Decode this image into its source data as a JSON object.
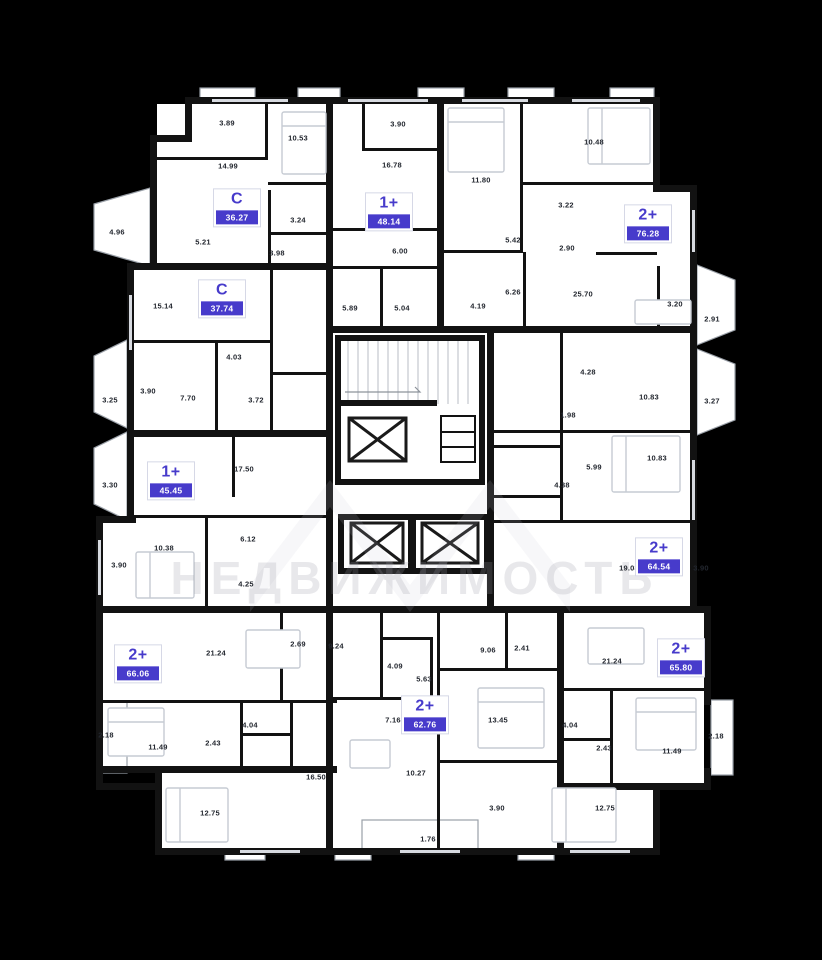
{
  "colors": {
    "background": "#000000",
    "floor": "#ffffff",
    "wall": "#121212",
    "accent": "#473bcb",
    "furniture": "#c6cbd3",
    "watermark": "#9b9ba6"
  },
  "watermark": {
    "text": "НЕДВИЖИМОСТЬ"
  },
  "apartments": [
    {
      "type": "С",
      "area": "36.27",
      "x": 237,
      "y": 208
    },
    {
      "type": "1+",
      "area": "48.14",
      "x": 389,
      "y": 212
    },
    {
      "type": "2+",
      "area": "76.28",
      "x": 648,
      "y": 224
    },
    {
      "type": "С",
      "area": "37.74",
      "x": 222,
      "y": 299
    },
    {
      "type": "1+",
      "area": "45.45",
      "x": 171,
      "y": 481
    },
    {
      "type": "2+",
      "area": "64.54",
      "x": 659,
      "y": 557
    },
    {
      "type": "2+",
      "area": "66.06",
      "x": 138,
      "y": 664
    },
    {
      "type": "2+",
      "area": "62.76",
      "x": 425,
      "y": 715
    },
    {
      "type": "2+",
      "area": "65.80",
      "x": 681,
      "y": 658
    }
  ],
  "rooms": [
    {
      "value": "3.89",
      "x": 227,
      "y": 123
    },
    {
      "value": "10.53",
      "x": 298,
      "y": 138
    },
    {
      "value": "14.99",
      "x": 228,
      "y": 166
    },
    {
      "value": "5.21",
      "x": 203,
      "y": 242
    },
    {
      "value": "3.24",
      "x": 298,
      "y": 220
    },
    {
      "value": "3.98",
      "x": 277,
      "y": 253
    },
    {
      "value": "4.96",
      "x": 117,
      "y": 232
    },
    {
      "value": "3.90",
      "x": 398,
      "y": 124
    },
    {
      "value": "16.78",
      "x": 392,
      "y": 165
    },
    {
      "value": "6.00",
      "x": 400,
      "y": 251
    },
    {
      "value": "5.89",
      "x": 350,
      "y": 308
    },
    {
      "value": "5.04",
      "x": 402,
      "y": 308
    },
    {
      "value": "11.80",
      "x": 481,
      "y": 180
    },
    {
      "value": "10.48",
      "x": 594,
      "y": 142
    },
    {
      "value": "3.22",
      "x": 566,
      "y": 205
    },
    {
      "value": "5.42",
      "x": 513,
      "y": 240
    },
    {
      "value": "2.90",
      "x": 567,
      "y": 248
    },
    {
      "value": "6.26",
      "x": 513,
      "y": 292
    },
    {
      "value": "4.19",
      "x": 478,
      "y": 306
    },
    {
      "value": "25.70",
      "x": 583,
      "y": 294
    },
    {
      "value": "3.20",
      "x": 675,
      "y": 304
    },
    {
      "value": "2.91",
      "x": 712,
      "y": 319
    },
    {
      "value": "15.14",
      "x": 163,
      "y": 306
    },
    {
      "value": "4.03",
      "x": 234,
      "y": 357
    },
    {
      "value": "3.90",
      "x": 148,
      "y": 391
    },
    {
      "value": "7.70",
      "x": 188,
      "y": 398
    },
    {
      "value": "3.72",
      "x": 256,
      "y": 400
    },
    {
      "value": "3.25",
      "x": 110,
      "y": 400
    },
    {
      "value": "17.50",
      "x": 244,
      "y": 469
    },
    {
      "value": "3.30",
      "x": 110,
      "y": 485
    },
    {
      "value": "10.38",
      "x": 164,
      "y": 548
    },
    {
      "value": "6.12",
      "x": 248,
      "y": 539
    },
    {
      "value": "3.90",
      "x": 119,
      "y": 565
    },
    {
      "value": "4.28",
      "x": 588,
      "y": 372
    },
    {
      "value": "10.83",
      "x": 649,
      "y": 397
    },
    {
      "value": "3.27",
      "x": 712,
      "y": 401
    },
    {
      "value": "1.98",
      "x": 568,
      "y": 415
    },
    {
      "value": "10.83",
      "x": 657,
      "y": 458
    },
    {
      "value": "5.99",
      "x": 594,
      "y": 467
    },
    {
      "value": "4.38",
      "x": 562,
      "y": 485
    },
    {
      "value": "19.08",
      "x": 629,
      "y": 568
    },
    {
      "value": "3.90",
      "x": 701,
      "y": 568
    },
    {
      "value": "4.25",
      "x": 246,
      "y": 584
    },
    {
      "value": "21.24",
      "x": 216,
      "y": 653
    },
    {
      "value": "2.69",
      "x": 298,
      "y": 644
    },
    {
      "value": "2.18",
      "x": 106,
      "y": 735
    },
    {
      "value": "11.49",
      "x": 158,
      "y": 747
    },
    {
      "value": "2.43",
      "x": 213,
      "y": 743
    },
    {
      "value": "4.04",
      "x": 250,
      "y": 725
    },
    {
      "value": "12.75",
      "x": 210,
      "y": 813
    },
    {
      "value": "16.50",
      "x": 316,
      "y": 777
    },
    {
      "value": "9.24",
      "x": 336,
      "y": 646
    },
    {
      "value": "4.09",
      "x": 395,
      "y": 666
    },
    {
      "value": "5.63",
      "x": 424,
      "y": 679
    },
    {
      "value": "9.06",
      "x": 488,
      "y": 650
    },
    {
      "value": "2.41",
      "x": 522,
      "y": 648
    },
    {
      "value": "7.16",
      "x": 393,
      "y": 720
    },
    {
      "value": "13.45",
      "x": 498,
      "y": 720
    },
    {
      "value": "10.27",
      "x": 416,
      "y": 773
    },
    {
      "value": "3.90",
      "x": 497,
      "y": 808
    },
    {
      "value": "1.76",
      "x": 428,
      "y": 839
    },
    {
      "value": "21.24",
      "x": 612,
      "y": 661
    },
    {
      "value": "4.04",
      "x": 570,
      "y": 725
    },
    {
      "value": "2.43",
      "x": 604,
      "y": 748
    },
    {
      "value": "11.49",
      "x": 672,
      "y": 751
    },
    {
      "value": "2.18",
      "x": 716,
      "y": 736
    },
    {
      "value": "12.75",
      "x": 605,
      "y": 808
    }
  ]
}
